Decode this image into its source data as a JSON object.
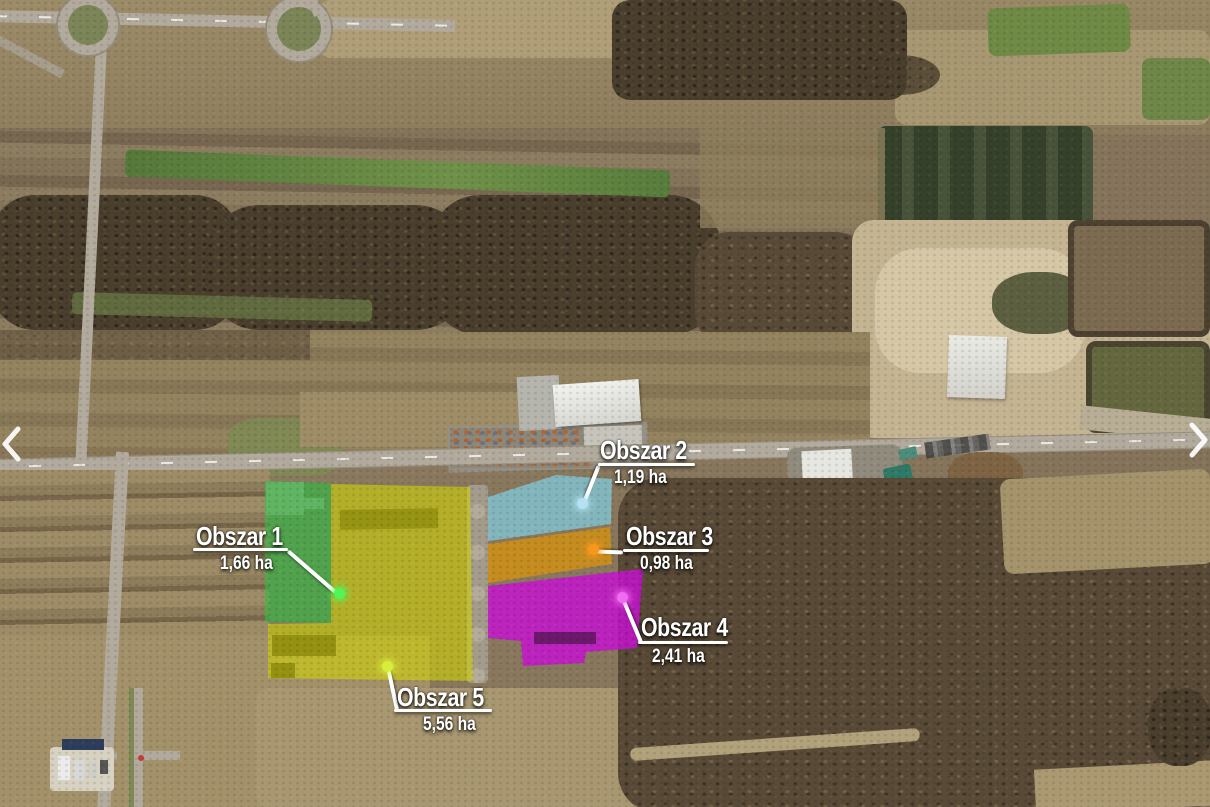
{
  "map": {
    "areas": [
      {
        "id": 1,
        "name": "Obszar 1",
        "area": "1,66 ha",
        "fill": "rgba(44,190,66,0.6)",
        "dot": "#52f556"
      },
      {
        "id": 2,
        "name": "Obszar 2",
        "area": "1,19 ha",
        "fill": "rgba(130,198,212,0.8)",
        "dot": "#b5e2f2"
      },
      {
        "id": 3,
        "name": "Obszar 3",
        "area": "0,98 ha",
        "fill": "rgba(214,146,14,0.78)",
        "dot": "#f7981d"
      },
      {
        "id": 4,
        "name": "Obszar 4",
        "area": "2,41 ha",
        "fill": "rgba(200,16,210,0.82)",
        "dot": "#ef6bf0"
      },
      {
        "id": 5,
        "name": "Obszar 5",
        "area": "5,56 ha",
        "fill": "rgba(206,208,10,0.62)",
        "dot": "#d9ee3b"
      }
    ],
    "nav": {
      "prev_icon": "chevron-left",
      "next_icon": "chevron-right"
    }
  }
}
